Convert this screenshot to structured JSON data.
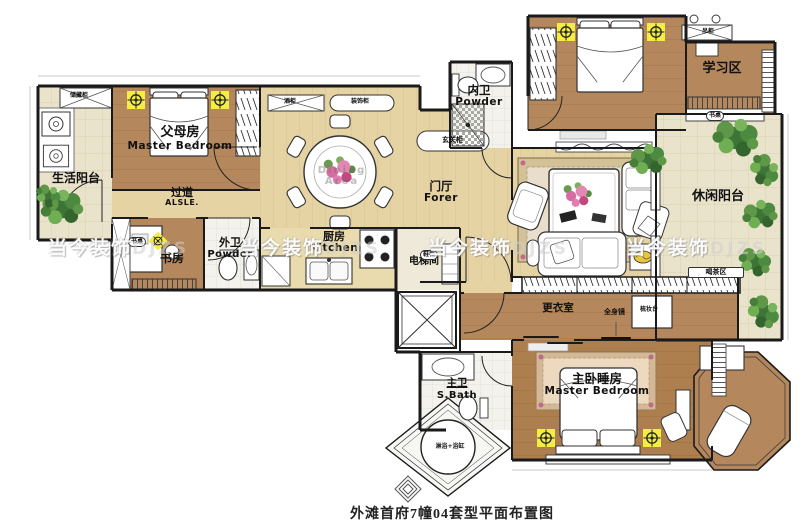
{
  "caption": "外滩首府7幢04套型平面布置图",
  "watermark": {
    "cn": "当今装饰",
    "latin": "DJZS"
  },
  "rooms": {
    "service_balcony": {
      "cn": "生活阳台"
    },
    "parents_room": {
      "cn": "父母房",
      "en": "Master Bedroom"
    },
    "aisle": {
      "cn": "过道",
      "en": "ALSLE."
    },
    "study": {
      "cn": "书房"
    },
    "guest_bath": {
      "cn": "外卫",
      "en": "Powder"
    },
    "kitchen": {
      "cn": "厨房",
      "en": "Kitchen"
    },
    "dining": {
      "en": "Dining Area"
    },
    "foyer": {
      "cn": "门厅",
      "en": "Forer"
    },
    "inner_bath": {
      "cn": "内卫",
      "en": "Powder"
    },
    "study_area": {
      "cn": "学习区"
    },
    "leisure_balcony": {
      "cn": "休闲阳台"
    },
    "elevator_room": {
      "cn": "电梯间"
    },
    "dressing_room": {
      "cn": "更衣室"
    },
    "master_bath": {
      "cn": "主卫",
      "en": "S.Bath"
    },
    "master_bedroom": {
      "cn": "主卧睡房",
      "en": "Master Bedroom"
    }
  },
  "fixtures": {
    "storage_cabinet": "储藏柜",
    "wine_cabinet": "酒柜",
    "decor_cabinet": "装饰柜",
    "entry_cabinet": "玄关柜",
    "shoe_cabinet": "鞋柜",
    "study_desk": "书桌",
    "hanging_cabinet": "吊柜",
    "area_desk": "书桌",
    "tea_area": "喝茶区",
    "full_mirror": "全身镜",
    "dresser": "梳妆台",
    "shower_tub": "淋浴+浴缸"
  },
  "colors": {
    "wood": "#b5875c",
    "wood_dark": "#ad7f4f",
    "wood_light": "#e6d3a4",
    "tile": "#eae3cc",
    "bath": "#f3f2ed",
    "lamp": "#f4ee43",
    "plant": "#4c8a3f",
    "carpet": "#d3c198",
    "wall": "#1a1a1a"
  }
}
